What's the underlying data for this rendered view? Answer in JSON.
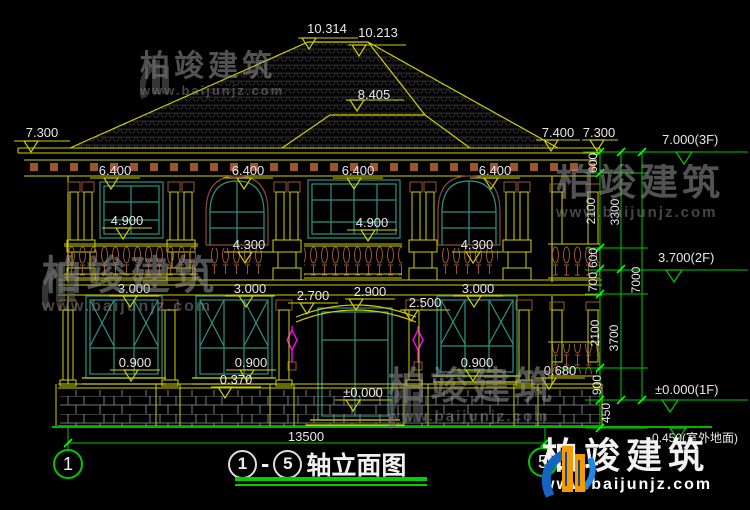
{
  "drawing": {
    "title": {
      "n1": "1",
      "dash": "-",
      "n5": "5",
      "text": "轴立面图"
    },
    "axis": {
      "left": "1",
      "right": "5"
    }
  },
  "levels": {
    "f3": "7.000(3F)",
    "f2": "3.700(2F)",
    "f1": "±0.000(1F)",
    "ground": "-0.450(室外地面)"
  },
  "marks": {
    "m10314": "10.314",
    "m10213": "10.213",
    "m8405": "8.405",
    "e73": "7.300",
    "e74": "7.400",
    "f64": "6.400",
    "w49": "4.900",
    "w43": "4.300",
    "w30": "3.000",
    "e27": "2.700",
    "e29": "2.900",
    "e25": "2.500",
    "s09": "0.900",
    "s037": "0.370",
    "s068": "0.680",
    "zero": "±0.000"
  },
  "dims": {
    "v600": "600",
    "v700": "700",
    "v900": "900",
    "v450": "450",
    "v2100": "2100",
    "v3300": "3300",
    "v3700": "3700",
    "v7000": "7000",
    "total_w": "13500"
  },
  "watermark": {
    "brand": "柏竣建筑",
    "url": "www.baijunjz.com"
  }
}
